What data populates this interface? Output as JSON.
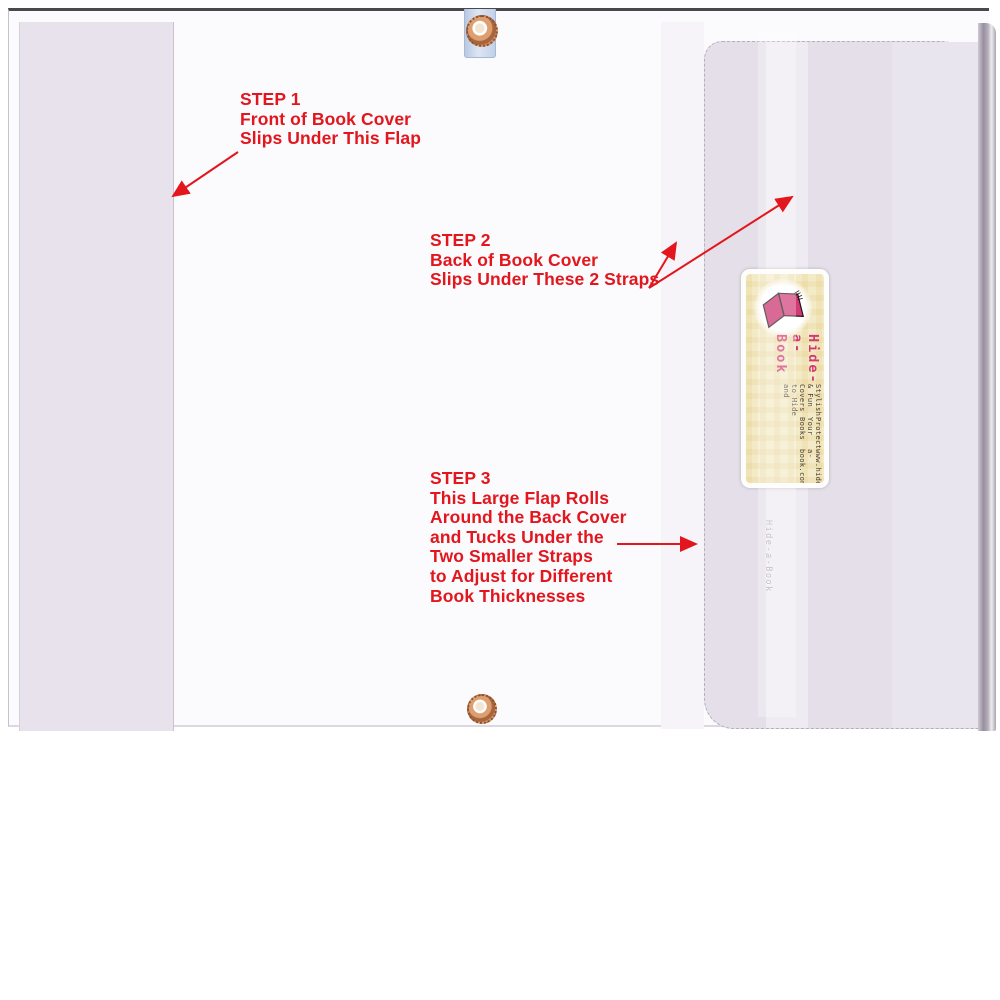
{
  "annotations": {
    "color": "#e2161c",
    "step1": {
      "title": "STEP 1",
      "line1": "Front of Book Cover",
      "line2": "Slips Under This Flap"
    },
    "step2": {
      "title": "STEP 2",
      "line1": "Back of Book Cover",
      "line2": "Slips Under These 2 Straps"
    },
    "step3": {
      "title": "STEP 3",
      "line1": "This Large Flap Rolls",
      "line2": "Around the Back Cover",
      "line3": "and Tucks Under the",
      "line4": "Two Smaller Straps",
      "line5": "to Adjust for Different",
      "line6": "Book Thicknesses"
    }
  },
  "card": {
    "brand": "Hide-a-Book",
    "tagline1": "Stylish & Fun Covers to Hide and",
    "tagline2": "Protect Your Books",
    "website": "www.hide-a-book.com"
  },
  "flap_label": "Hide-a-Book",
  "icons": {
    "logo": "open-book-icon",
    "fasteners": "copper-eyelet-icon"
  },
  "colors": {
    "annotation_red": "#e2161c",
    "brand_pink": "#d43a72",
    "card_cream": "#f3ebc8",
    "flap_lavender": "#e4dfe9",
    "grommet_copper": "#c08154"
  }
}
